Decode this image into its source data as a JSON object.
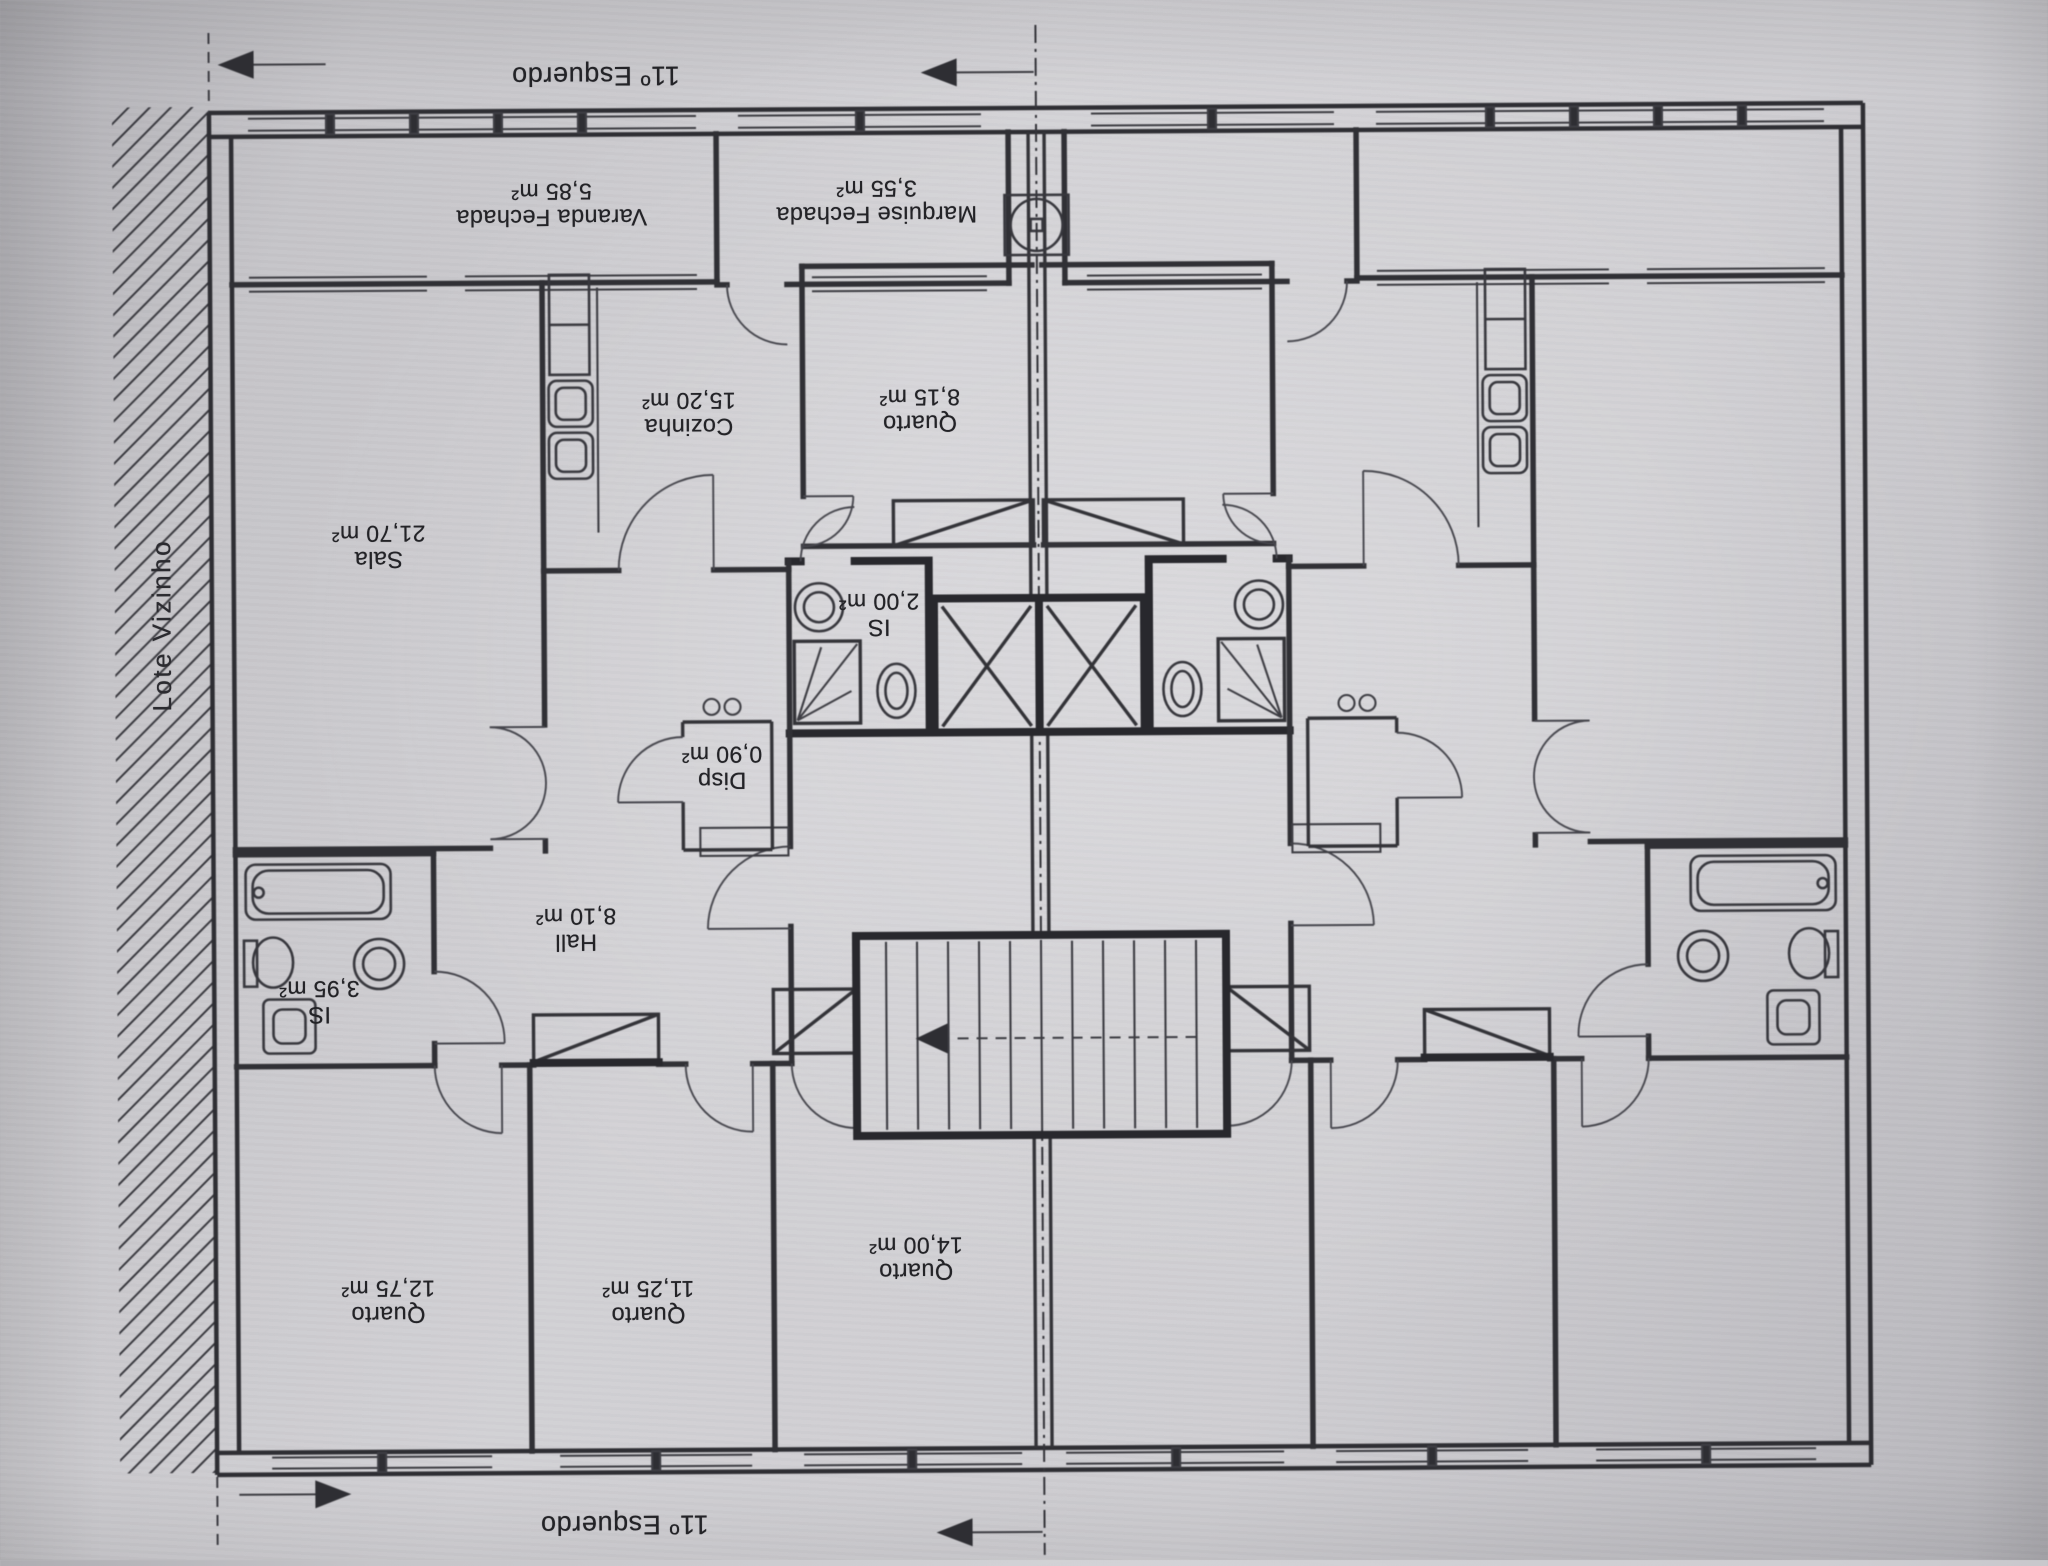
{
  "labels": {
    "top_floor": "11º Esquerdo",
    "bottom_floor": "11º Esquerdo",
    "neighbor_lot": "Lote Vizinho"
  },
  "rooms": {
    "varanda": {
      "name": "Varanda Fechada",
      "area": "5,85 m²"
    },
    "marquise": {
      "name": "Marquise Fechada",
      "area": "3,55 m²"
    },
    "cozinha": {
      "name": "Cozinha",
      "area": "15,20 m²"
    },
    "quarto_815": {
      "name": "Quarto",
      "area": "8,15 m²"
    },
    "sala": {
      "name": "Sala",
      "area": "21,70 m²"
    },
    "is_200": {
      "name": "IS",
      "area": "2,00 m²"
    },
    "disp": {
      "name": "Disp",
      "area": "0,90 m²"
    },
    "hall": {
      "name": "Hall",
      "area": "8,10 m²"
    },
    "is_395": {
      "name": "IS",
      "area": "3,95 m²"
    },
    "quarto_1275": {
      "name": "Quarto",
      "area": "12,75 m²"
    },
    "quarto_1125": {
      "name": "Quarto",
      "area": "11,25 m²"
    },
    "quarto_1400": {
      "name": "Quarto",
      "area": "14,00 m²"
    }
  },
  "colors": {
    "paper": "#cfced2",
    "ink": "#2c2c31"
  }
}
